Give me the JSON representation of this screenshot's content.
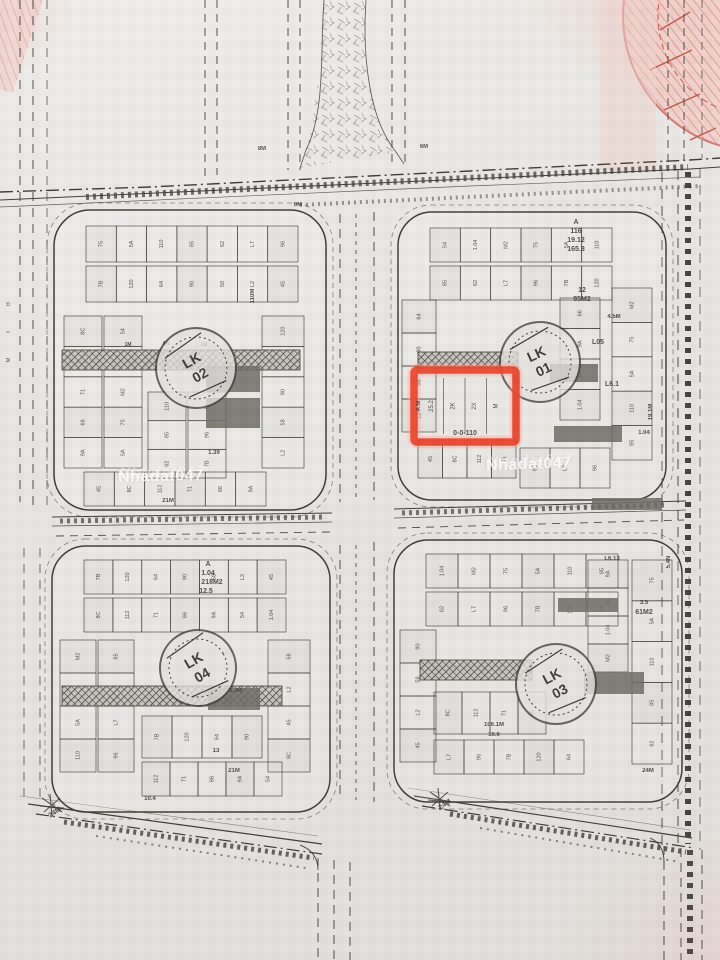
{
  "document": {
    "kind": "scanned land subdivision plan",
    "highlight_color": "#f2432c",
    "ink_color": "#3e3c37",
    "paper_color": "#e9e7e3"
  },
  "watermark": {
    "text": "Nhadat047"
  },
  "highlight": {
    "cells": [
      "25.2",
      "2K",
      "2X",
      "M"
    ],
    "red_row": "0-0-110",
    "side": "A M"
  },
  "stamps": [
    {
      "line1": "LK",
      "line2": "02"
    },
    {
      "line1": "LK",
      "line2": "01"
    },
    {
      "line1": "LK",
      "line2": "04"
    },
    {
      "line1": "LK",
      "line2": "03"
    }
  ],
  "plot_glyphs": [
    "75",
    "5A",
    "110",
    "85",
    "62",
    "L7",
    "96",
    "7B",
    "120",
    "64",
    "90",
    "58",
    "L2",
    "45",
    "8C",
    "112",
    "71",
    "66",
    "9A",
    "54",
    "1.04",
    "M2"
  ],
  "blocks": [
    {
      "name": "top-left",
      "labels": [
        "6M",
        "1M",
        "AN",
        "1M",
        "21M",
        "1.39",
        "110M"
      ]
    },
    {
      "name": "top-right",
      "labels": [
        "A",
        "116",
        "19.12",
        "165.8",
        "12",
        "85M2",
        "L05",
        "L6.1",
        "4.5M",
        "19.1M",
        "1.04"
      ]
    },
    {
      "name": "bottom-left",
      "labels": [
        "A",
        "1.04",
        "218M2",
        "12.5",
        "L.04",
        "13",
        "21M",
        "10.4"
      ]
    },
    {
      "name": "bottom-right",
      "labels": [
        "L6.13",
        "3.5",
        "61M2",
        "106.1M",
        "10.6",
        "5.4N",
        "24M"
      ]
    }
  ],
  "edge_glyphs": [
    "B",
    "T",
    "M"
  ],
  "road_labels": [
    "24M",
    "24M",
    "8M",
    "6M"
  ]
}
